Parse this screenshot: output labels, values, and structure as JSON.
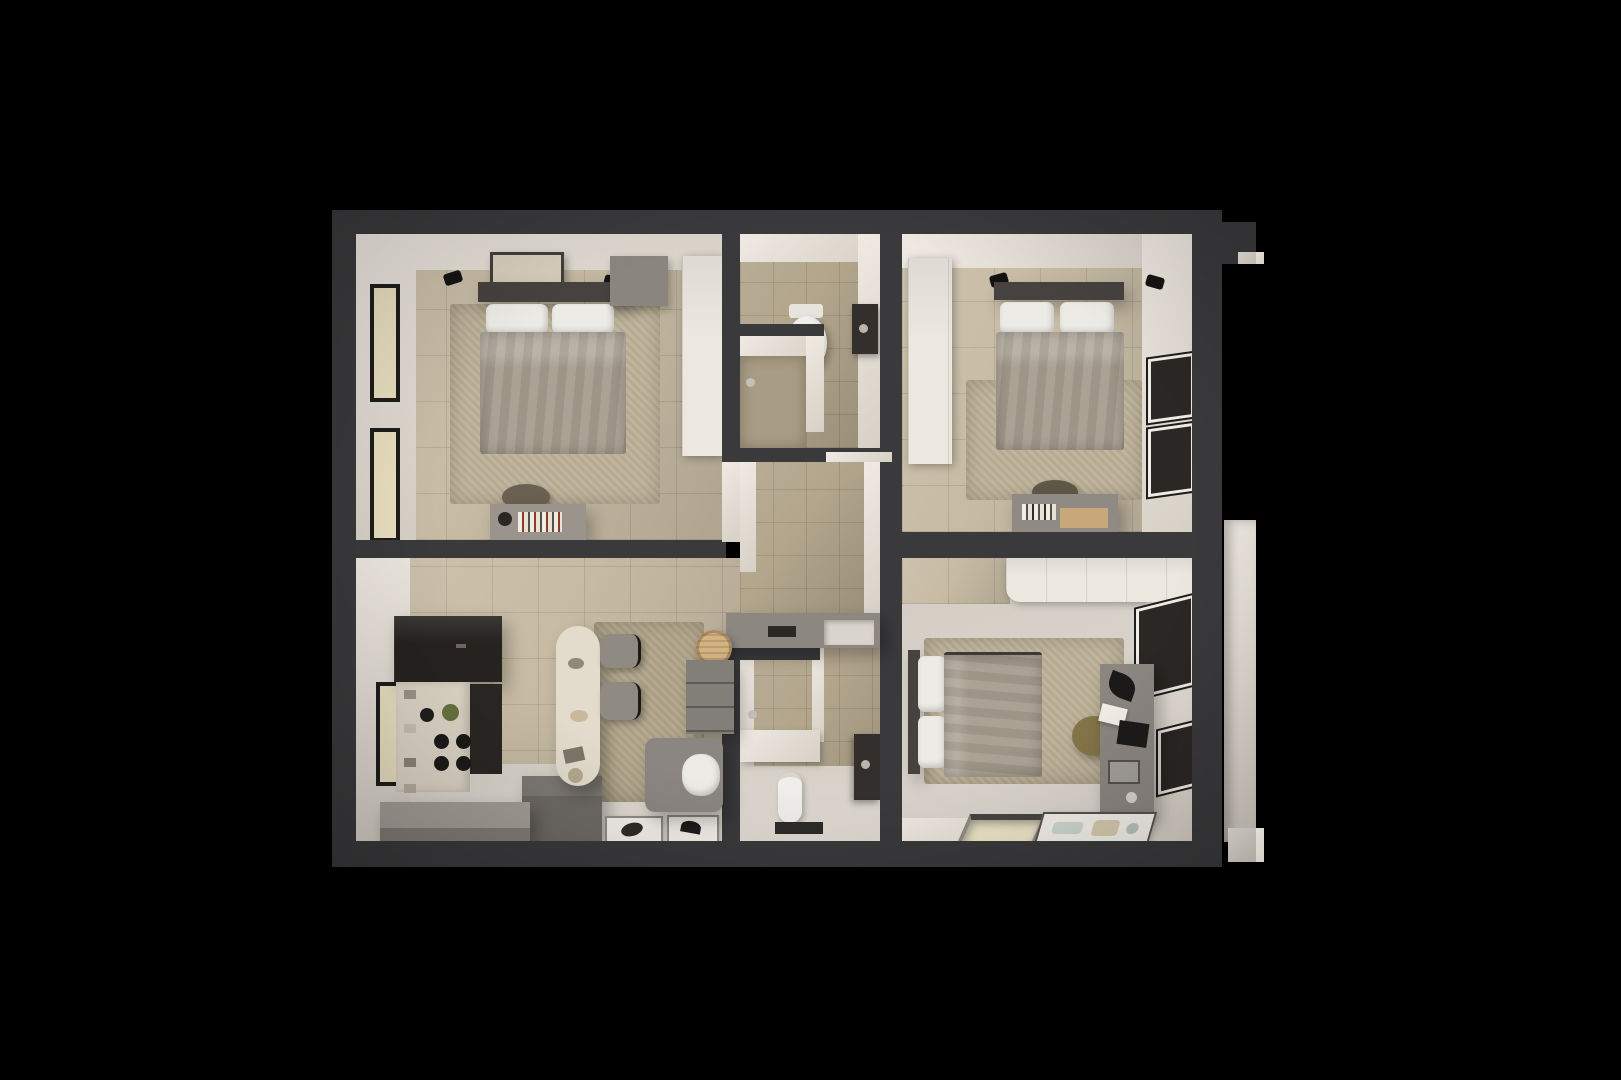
{
  "scene": {
    "type": "3d-apartment-floorplan-render",
    "view": "top-down",
    "rooms": [
      {
        "id": "bedroom-top-left",
        "furniture": [
          "double-bed",
          "headboard",
          "pillows",
          "wall-art",
          "wall-lamps",
          "dresser",
          "wardrobe",
          "desk",
          "books",
          "chair",
          "windows-left"
        ]
      },
      {
        "id": "bathroom-top",
        "furniture": [
          "toilet",
          "vanity-sink",
          "shower-enclosure",
          "shower-head"
        ]
      },
      {
        "id": "hallway-entry",
        "furniture": [
          "console-cabinet",
          "tray",
          "basin",
          "rattan-pouf",
          "drawer-cabinet",
          "armchair",
          "throw-pillow"
        ]
      },
      {
        "id": "bedroom-top-right",
        "furniture": [
          "double-bed",
          "headboard",
          "pillows",
          "wall-lamps",
          "wardrobe",
          "rug",
          "desk",
          "chair",
          "windows-right"
        ]
      },
      {
        "id": "kitchen-living",
        "furniture": [
          "dark-cabinets",
          "counter",
          "cooktop",
          "jars",
          "plant",
          "island-bench",
          "l-bench",
          "dining-table",
          "dining-chairs",
          "dining-rug",
          "floor-art-frames",
          "window-left"
        ]
      },
      {
        "id": "bathroom-bottom",
        "furniture": [
          "shower-enclosure",
          "shower-head",
          "toilet",
          "vanity-sink",
          "bench"
        ]
      },
      {
        "id": "bedroom-bottom-right",
        "furniture": [
          "double-bed",
          "pillows",
          "wardrobe",
          "rug",
          "desk",
          "desk-lamp",
          "laptop",
          "chair",
          "windows-right",
          "floor-opening",
          "floor-art"
        ]
      }
    ],
    "exterior": [
      "outer-walls",
      "top-right-notch",
      "right-balcony-wall"
    ]
  },
  "palette": {
    "background": "#000000",
    "wall_dark": "#3a393b",
    "wall_white": "#efeae2",
    "wall_white_dim": "#d6d0c6",
    "floor_tile": "#c7bba4",
    "floor_tile_dark": "#b3a68d",
    "floor_light": "#d8d3ca",
    "rug": "#bdb198",
    "duvet": "#a69c8e",
    "pillow": "#edebe6",
    "headboard": "#46423f",
    "wardrobe": "#ece8e0",
    "kitchen_dark": "#262220",
    "counter": "#ded5c6",
    "island_light": "#a39e97",
    "island_dark": "#6e6a66",
    "table": "#e3dccd",
    "chair": "#8f8a82",
    "chair_olive": "#6a6152",
    "chair_tan": "#857648",
    "rattan": "#d3b384",
    "sofa": "#8b8681",
    "desk": "#8b8680",
    "window_frame": "#1e1d1c",
    "glass_cream": "#eadfc0",
    "glass_dark": "#2a2724",
    "fixture_white": "#f0eeea",
    "vanity_dark": "#332f2c"
  }
}
